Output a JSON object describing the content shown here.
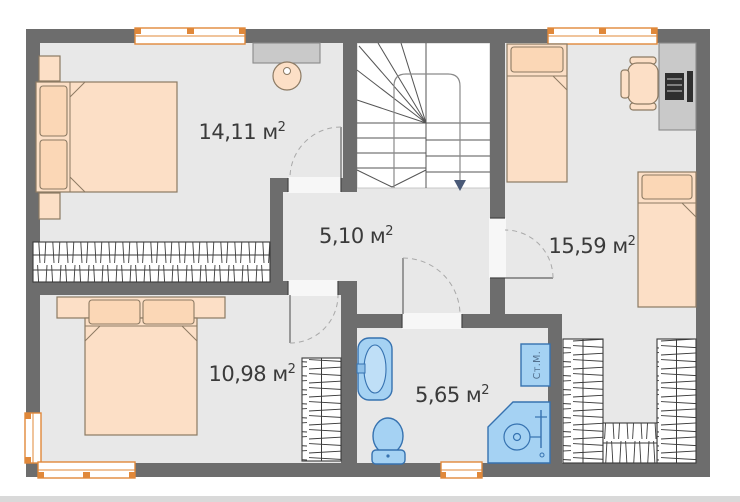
{
  "plan_title": "floor-plan",
  "rooms": [
    {
      "name": "bedroom-1",
      "area": "14,11 м",
      "sup": "2"
    },
    {
      "name": "hall",
      "area": "5,10 м",
      "sup": "2"
    },
    {
      "name": "kids-bedroom",
      "area": "15,59 м",
      "sup": "2"
    },
    {
      "name": "bedroom-2",
      "area": "10,98 м",
      "sup": "2"
    },
    {
      "name": "bathroom",
      "area": "5,65 м",
      "sup": "2"
    }
  ],
  "appliances": {
    "washing_machine_label": "Ст.М."
  },
  "colors": {
    "wall": "#6d6d6d",
    "floor": "#e8e8e8",
    "window_frame": "#e0883a",
    "plumbing_fill": "#a5d2f3",
    "plumbing_stroke": "#3672b0",
    "furniture_fill": "#fcdfc6",
    "furniture_stroke": "#8c7a63",
    "casework_gray": "#c9c9c9"
  }
}
